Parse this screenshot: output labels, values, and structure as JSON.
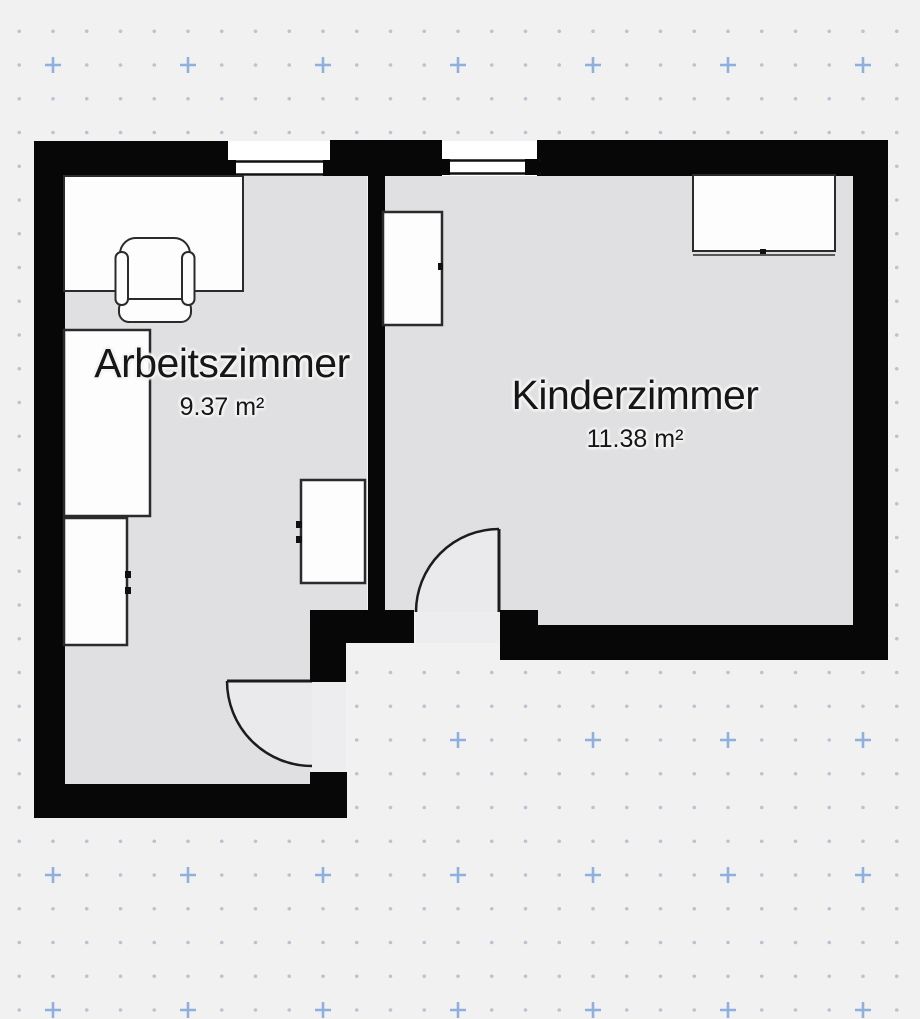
{
  "view": {
    "type": "floor-plan",
    "background": "#f1f1f2"
  },
  "grid": {
    "dot_color": "#b9c3d2",
    "plus_color": "#8fb0dd",
    "dot_spacing_px": 33.75,
    "plus_spacing_px": 135
  },
  "palette": {
    "wall": "#070707",
    "floor": "#e0e0e2",
    "door_swing": "#eaeaec",
    "threshold": "#ededef",
    "furniture_fill": "#fdfdfd",
    "furniture_outline": "#2b2b2b",
    "label_color": "#161616",
    "label_halo": "#f4f4f4"
  },
  "rooms": [
    {
      "name": "Arbeitszimmer",
      "area": "9.37 m²"
    },
    {
      "name": "Kinderzimmer",
      "area": "11.38 m²"
    }
  ],
  "fixtures": {
    "windows": [
      "window-arbeitszimmer",
      "window-kinderzimmer"
    ],
    "doors": [
      "door-arbeitszimmer",
      "door-kinderzimmer"
    ]
  },
  "furniture": [
    "desk",
    "office-chair",
    "tall-cabinet",
    "small-cabinet",
    "dresser",
    "wardrobe",
    "sideboard"
  ]
}
